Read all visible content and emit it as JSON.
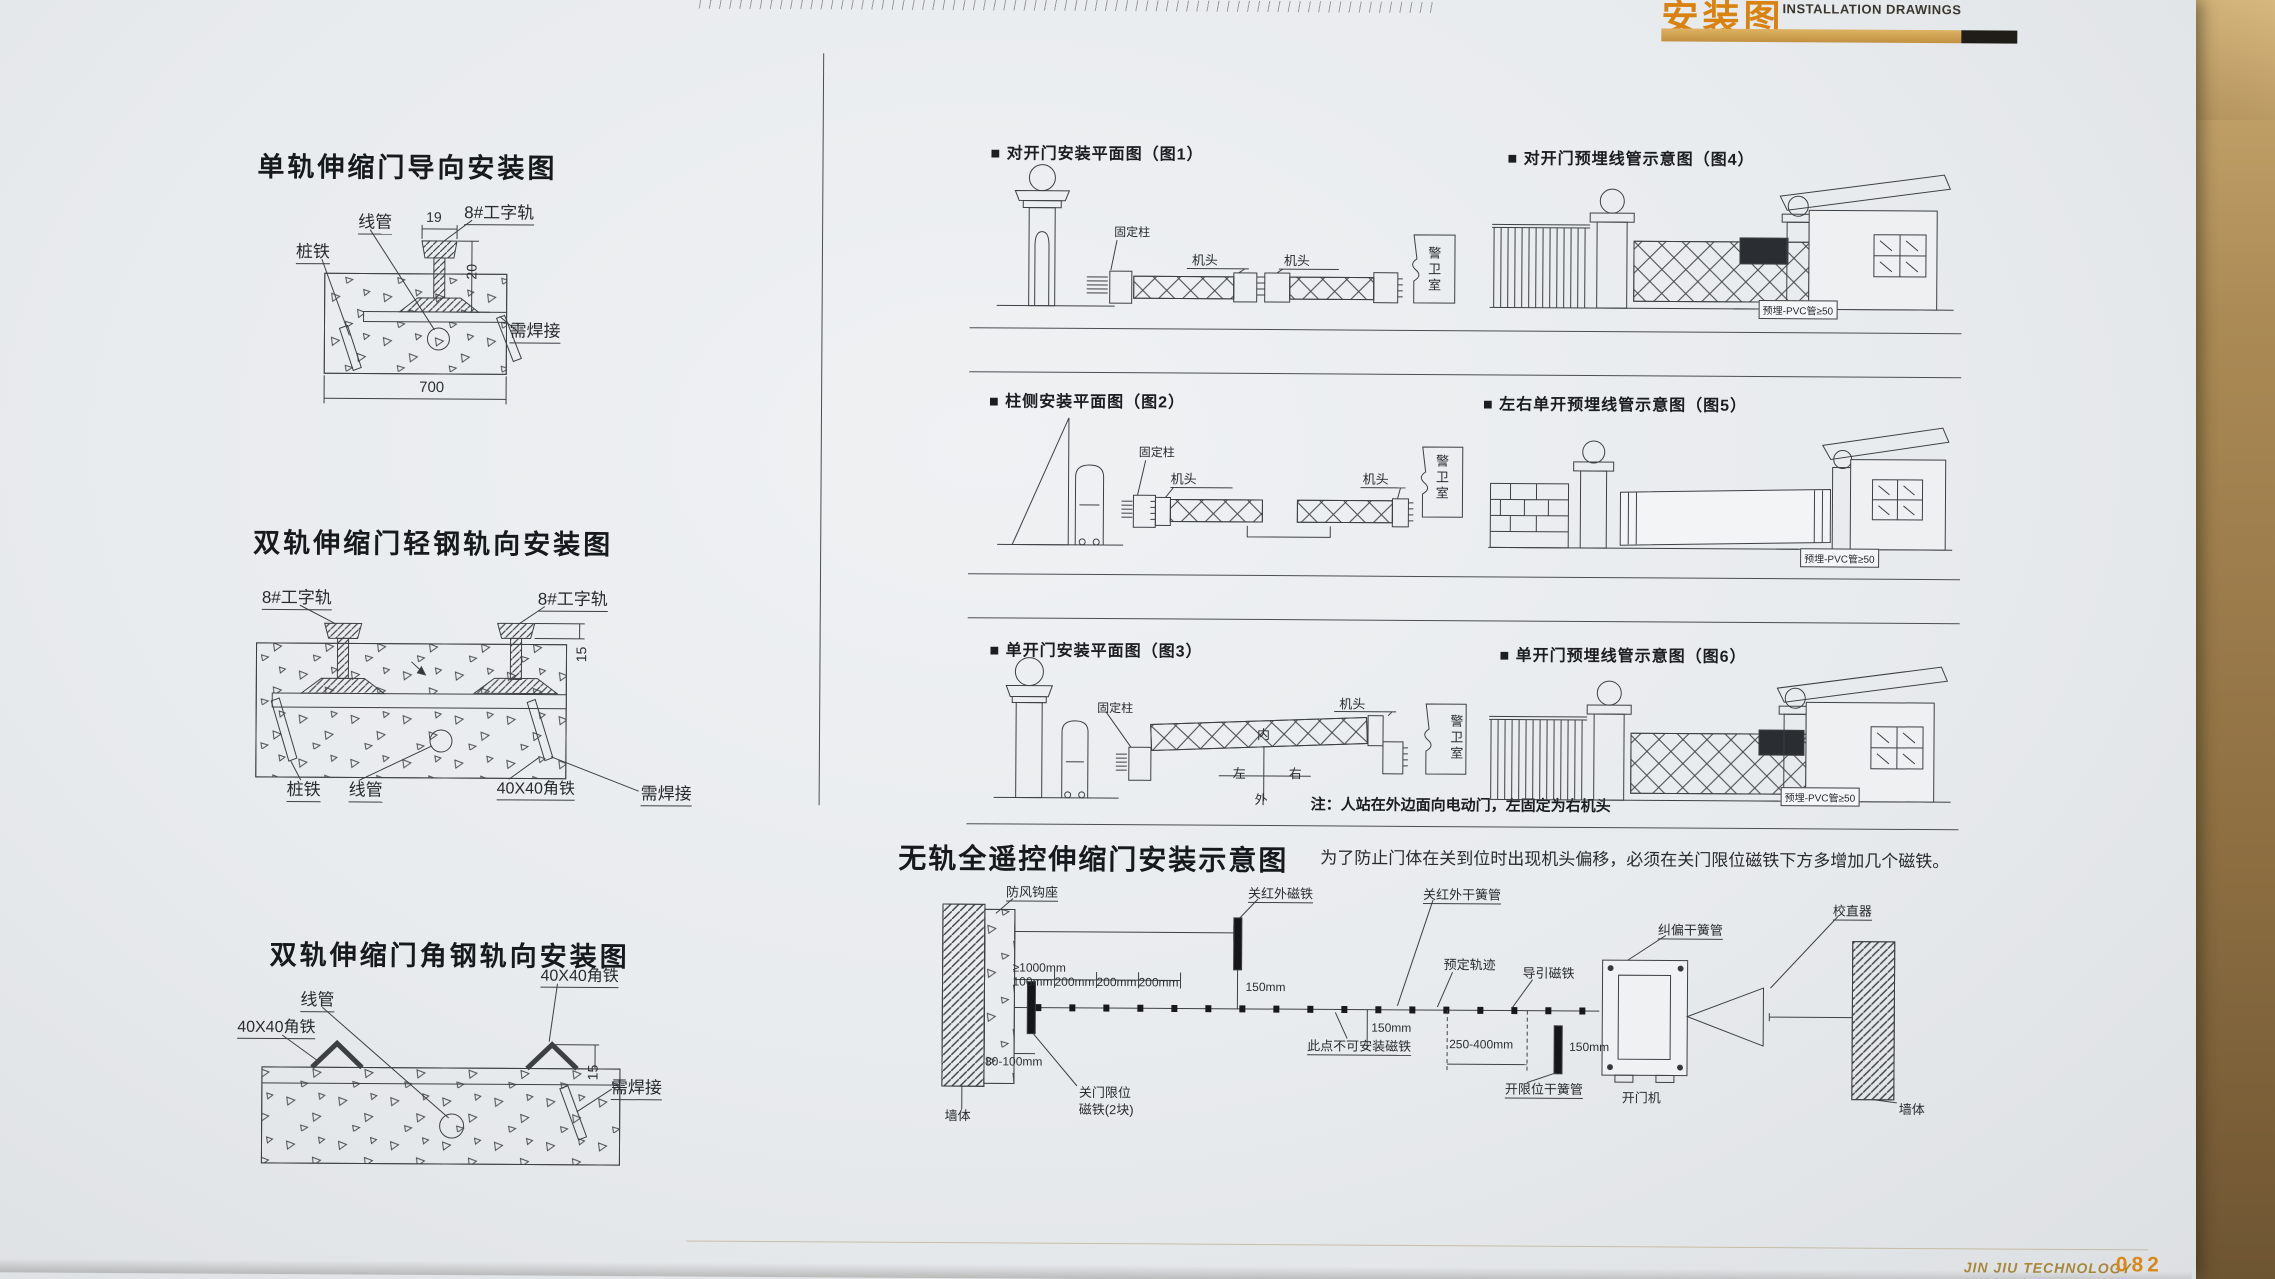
{
  "photo": {
    "header_cn": "安装图",
    "header_en": "INSTALLATION DRAWINGS",
    "footer_brand": "JIN JIU TECHNOLOGY",
    "footer_page": "082"
  },
  "d1": {
    "title": "单轨伸缩门导向安装图",
    "lbl_conduit": "线管",
    "lbl_stake": "桩铁",
    "lbl_rail": "8#工字轨",
    "dim_top": "19",
    "dim_side": "20",
    "dim_bottom": "700",
    "lbl_weld": "需焊接"
  },
  "d2": {
    "title": "双轨伸缩门轻钢轨向安装图",
    "lbl_rail_left": "8#工字轨",
    "lbl_rail_right": "8#工字轨",
    "dim_side": "15",
    "lbl_stake": "桩铁",
    "lbl_conduit": "线管",
    "lbl_angle": "40X40角铁",
    "lbl_weld": "需焊接"
  },
  "d3": {
    "title": "双轨伸缩门角钢轨向安装图",
    "lbl_conduit": "线管",
    "lbl_angle_left": "40X40角铁",
    "lbl_angle_right": "40X40角铁",
    "dim_side": "15",
    "lbl_weld": "需焊接"
  },
  "plan1": {
    "title": "■ 对开门安装平面图（图1）",
    "lbl_fixed_post": "固定柱",
    "lbl_head_a": "机头",
    "lbl_head_b": "机头",
    "lbl_guard": "警卫室"
  },
  "elev4": {
    "title": "■ 对开门预埋线管示意图（图4）",
    "lbl_pvc": "预埋-PVC管≥50"
  },
  "plan2": {
    "title": "■ 柱侧安装平面图（图2）",
    "lbl_fixed_post": "固定柱",
    "lbl_head_a": "机头",
    "lbl_head_b": "机头",
    "lbl_guard": "警卫室"
  },
  "elev5": {
    "title": "■ 左右单开预埋线管示意图（图5）",
    "lbl_pvc": "预埋-PVC管≥50"
  },
  "plan3": {
    "title": "■ 单开门安装平面图（图3）",
    "lbl_fixed_post": "固定柱",
    "lbl_head": "机头",
    "lbl_guard": "警卫室",
    "compass_n": "内",
    "compass_s": "外",
    "compass_w": "左",
    "compass_e": "右",
    "note": "注：人站在外边面向电动门，左固定为右机头"
  },
  "elev6": {
    "title": "■ 单开门预埋线管示意图（图6）",
    "lbl_pvc": "预埋-PVC管≥50"
  },
  "trackless": {
    "title": "无轨全遥控伸缩门安装示意图",
    "note": "为了防止门体在关到位时出现机头偏移，必须在关门限位磁铁下方多增加几个磁铁。",
    "lbl_wall_left": "墙体",
    "lbl_wall_right": "墙体",
    "lbl_wind_hook": "防风钩座",
    "dim_ge1000": "≥1000mm",
    "lbl_close_ir_magnet": "关红外磁铁",
    "lbl_close_ir_reed": "关红外干簧管",
    "lbl_straightener": "校直器",
    "lbl_deviation_reed": "纠偏干簧管",
    "dim_100": "100mm",
    "dim_200a": "200mm",
    "dim_200b": "200mm",
    "dim_200c": "200mm",
    "dim_150a": "150mm",
    "dim_150b": "150mm",
    "dim_150c": "150mm",
    "lbl_track": "预定轨迹",
    "lbl_guide_magnet": "导引磁铁",
    "lbl_no_magnet": "此点不可安装磁铁",
    "dim_250_400": "250-400mm",
    "dim_80_100": "80-100mm",
    "lbl_close_limit_1": "关门限位",
    "lbl_close_limit_2": "磁铁(2块)",
    "lbl_open_limit_reed": "开限位干簧管",
    "lbl_opener": "开门机"
  }
}
